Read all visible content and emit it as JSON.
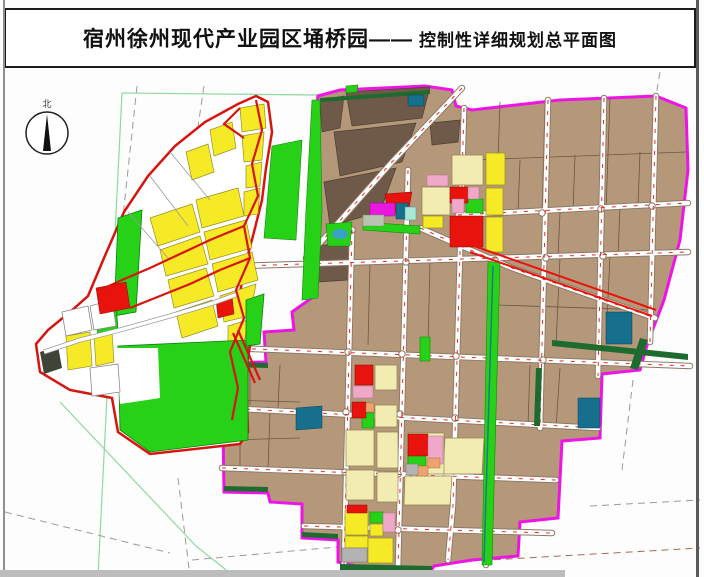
{
  "title": {
    "main": "宿州徐州现代产业园区埇桥园——",
    "sub": "控制性详细规划总平面图"
  },
  "compass": {
    "label": "北"
  },
  "palette": {
    "site_boundary_left": "#d6150f",
    "site_boundary_right": "#ee14e6",
    "industrial_tan": "#b5987a",
    "village_dark_brown": "#6f5948",
    "residential_yellow": "#f6e926",
    "residential_cream": "#f2ecb2",
    "green_space": "#27d117",
    "street_green": "#1d6b2f",
    "public_red": "#e8130c",
    "pink": "#f0a8c8",
    "orange": "#eda36f",
    "commercial_magenta": "#e818e0",
    "utility_teal": "#176f8e",
    "cyan": "#a8e8d8",
    "gray": "#b3b3b3"
  },
  "map": {
    "road_style": {
      "casing": "#8a7866",
      "casing_w": 6.5,
      "fill": "#ffffff",
      "fill_w": 4.6,
      "center": "#e03022"
    },
    "roads": [
      "240,266 688,252",
      "230,348 690,366",
      "224,408 598,428",
      "222,468 556,480",
      "304,526 552,533",
      "458,215 688,203",
      "352,230 344,565",
      "408,170 398,568",
      "464,108 453,505 448,560",
      "494,262 486,565",
      "548,100 540,428",
      "604,98 598,376",
      "656,96 650,342",
      "462,88 392,162 330,232 306,258",
      "420,228 512,268 655,318"
    ],
    "intersections": [
      [
        348,
        352
      ],
      [
        402,
        354
      ],
      [
        456,
        356
      ],
      [
        489,
        358
      ],
      [
        543,
        360
      ],
      [
        406,
        262
      ],
      [
        495,
        260
      ],
      [
        546,
        258
      ],
      [
        603,
        256
      ],
      [
        346,
        412
      ],
      [
        400,
        414
      ],
      [
        455,
        418
      ],
      [
        488,
        420
      ],
      [
        345,
        472
      ],
      [
        398,
        474
      ],
      [
        398,
        530
      ],
      [
        542,
        213
      ],
      [
        601,
        209
      ],
      [
        652,
        206
      ],
      [
        352,
        230
      ]
    ],
    "layers": [
      {
        "n": "survey-line-green",
        "t": "line",
        "s": "#8fd8a0",
        "w": 1.2,
        "sh": [
          "122,93 98,577",
          "122,93 318,95",
          "60,402 196,546",
          "196,546 235,577"
        ]
      },
      {
        "n": "survey-line-dashed",
        "t": "line",
        "s": "#9a9a9a",
        "w": 1,
        "d": "7 5",
        "sh": [
          "137,86 116,282",
          "204,86 178,262",
          "5,512 170,553",
          "178,478 190,577",
          "192,560 348,546",
          "633,380 622,470",
          "590,506 700,500",
          "660,72 656,96"
        ]
      },
      {
        "n": "survey-line-dashed-brown",
        "t": "line",
        "s": "#a06b50",
        "w": 1,
        "d": "7 5",
        "sh": [
          "350,568 700,548"
        ]
      },
      {
        "n": "site-east-boundary",
        "t": "poly",
        "f": "#b5987a",
        "s": "#ee14e6",
        "w": 3,
        "sh": [
          "318,96 340,90 425,86 452,90 456,106 472,110 560,100 656,96 686,108 688,170 680,240 664,300 648,342 640,370 602,374 600,438 562,441 558,518 520,522 518,556 472,560 434,566 430,572 390,572 356,566 338,562 338,540 302,538 302,504 270,502 268,493 224,492 222,363 266,362 264,332 294,330 292,312 313,297 310,200 314,130"
        ]
      },
      {
        "n": "parcel-village",
        "t": "poly",
        "f": "#6f5948",
        "s": "#4e3e30",
        "w": 0.7,
        "sh": [
          "346,92 430,87 422,118 352,126",
          "334,132 416,123 402,162 340,176",
          "324,182 396,168 380,212 330,226",
          "320,100 344,96 340,128 322,132",
          "430,123 460,120 458,142 432,145",
          "316,246 352,242 348,280 318,282"
        ]
      },
      {
        "n": "parcel-line",
        "t": "line",
        "s": "#6b5742",
        "w": 0.8,
        "sh": [
          "470,160 686,152",
          "545,102 542,215",
          "610,98 606,210",
          "655,96 652,205",
          "500,102 498,160",
          "520,160 518,212",
          "575,155 573,212",
          "640,152 638,205",
          "500,215 498,260",
          "560,212 558,258",
          "620,208 618,256",
          "560,258 556,345",
          "610,256 606,340",
          "498,305 650,310",
          "430,262 428,345",
          "370,262 368,345",
          "250,368 250,405",
          "280,365 278,408",
          "240,415 240,468",
          "270,412 268,470",
          "530,365 528,425",
          "560,368 556,428",
          "226,400 300,402",
          "226,440 300,438"
        ]
      },
      {
        "n": "road-network",
        "t": "roads"
      },
      {
        "n": "canal-greenway",
        "t": "poly",
        "f": "#27d117",
        "s": "#128a0a",
        "w": 0.6,
        "sh": [
          "488,262 500,262 492,565 482,565"
        ]
      },
      {
        "n": "canal-line",
        "t": "line",
        "s": "#1b7a8e",
        "w": 1.5,
        "sh": [
          "493,266 484,562"
        ]
      },
      {
        "n": "street-green-verge",
        "t": "poly",
        "f": "#1d6b2f",
        "sh": [
          "552,340 688,354 688,360 552,346",
          "340,564 432,566 432,572 340,570",
          "320,98 430,90 430,94 320,102",
          "536,368 542,368 540,426 534,426",
          "224,486 268,487 268,492 224,491",
          "302,532 338,534 338,539 302,537",
          "640,338 648,340 638,370 630,368",
          "224,362 268,363 268,368 224,367"
        ]
      },
      {
        "n": "parcel-cream",
        "t": "poly",
        "f": "#f2ecb2",
        "s": "#8f8350",
        "w": 0.7,
        "sh": [
          "452,155 483,155 483,185 452,185",
          "422,187 450,187 450,215 422,215",
          "346,430 374,430 374,466 346,466",
          "377,432 398,432 398,468 377,468",
          "445,438 484,438 482,474 443,474",
          "405,476 452,476 450,505 404,505",
          "346,470 374,470 374,500 346,500",
          "377,472 398,472 398,502 377,502",
          "375,365 397,365 397,390 375,390",
          "375,405 397,405 397,427 375,427",
          "408,433 444,433 444,474 408,474"
        ]
      },
      {
        "n": "parcel-green",
        "t": "poly",
        "f": "#27d117",
        "s": "#128a0a",
        "w": 0.6,
        "sh": [
          "312,100 320,100 322,210 318,298 302,300 306,210",
          "272,146 302,140 296,240 264,238",
          "326,224 352,222 350,246 328,246",
          "363,222 420,226 420,234 363,230",
          "466,199 483,199 483,213 466,213",
          "408,450 426,450 426,466 408,466",
          "362,413 374,413 374,428 362,428",
          "370,512 383,512 383,523 370,523",
          "420,337 430,337 430,361 420,361",
          "346,86 358,85 357,92 346,93"
        ]
      },
      {
        "n": "pond",
        "t": "ellipse",
        "f": "#3aa0c8",
        "sh": [
          [
            340,
            234,
            8,
            5
          ]
        ]
      },
      {
        "n": "parcel-yellow-east",
        "t": "poly",
        "f": "#f6e926",
        "s": "#97902a",
        "w": 0.7,
        "sh": [
          "486,153 505,153 505,185 486,185",
          "486,188 503,188 503,215 486,215",
          "486,217 503,217 503,252 486,252",
          "423,216 443,216 443,228 423,228",
          "345,510 368,510 368,535 345,535",
          "345,536 368,536 368,548 345,548",
          "368,538 393,538 393,563 368,563",
          "370,524 383,524 383,536 370,536"
        ]
      },
      {
        "n": "parcel-red",
        "t": "poly",
        "f": "#e8130c",
        "s": "#8f0a06",
        "w": 0.5,
        "sh": [
          "450,187 468,187 468,203 450,203",
          "450,216 483,216 483,247 450,247",
          "385,194 412,192 408,212 388,214",
          "355,365 373,365 373,385 355,385",
          "352,402 366,402 366,418 352,418",
          "408,434 428,434 428,456 408,456",
          "347,505 367,505 367,513 347,513"
        ]
      },
      {
        "n": "parcel-pink",
        "t": "poly",
        "f": "#f0a8c8",
        "s": "#b06f8d",
        "w": 0.5,
        "sh": [
          "427,175 448,175 448,186 427,186",
          "468,187 479,187 479,199 468,199",
          "353,386 373,386 373,398 353,398",
          "428,436 443,436 443,464 428,464",
          "383,513 395,513 395,532 383,532",
          "452,199 464,199 464,213 452,213"
        ]
      },
      {
        "n": "parcel-orange",
        "t": "poly",
        "f": "#eda36f",
        "s": "#a86a3a",
        "w": 0.5,
        "sh": [
          "427,458 440,458 440,468 427,468",
          "366,403 374,403 374,412 366,412",
          "416,466 428,466 428,476 416,476"
        ]
      },
      {
        "n": "parcel-commercial-magenta",
        "t": "poly",
        "f": "#e818e0",
        "s": "#8d0d88",
        "w": 0.5,
        "sh": [
          "370,203 395,203 395,216 370,216"
        ]
      },
      {
        "n": "parcel-teal",
        "t": "poly",
        "f": "#176f8e",
        "s": "#0d4456",
        "w": 0.5,
        "sh": [
          "396,203 408,203 408,219 396,219",
          "606,312 632,312 632,344 606,344",
          "408,95 424,95 424,106 408,106",
          "578,398 600,398 600,428 578,428",
          "296,408 322,406 322,428 296,430"
        ]
      },
      {
        "n": "parcel-cyan",
        "t": "poly",
        "f": "#a8e8d8",
        "s": "#4d9a8a",
        "w": 0.5,
        "sh": [
          "405,207 416,207 416,220 405,220"
        ]
      },
      {
        "n": "parcel-graygreen",
        "t": "poly",
        "f": "#b9c4b0",
        "s": "#7a8a72",
        "w": 0.5,
        "sh": [
          "363,215 384,215 384,226 363,226"
        ]
      },
      {
        "n": "parcel-gray",
        "t": "poly",
        "f": "#b3b3b3",
        "s": "#777777",
        "w": 0.5,
        "sh": [
          "342,548 367,548 367,562 342,562",
          "406,464 418,464 418,475 406,475"
        ]
      },
      {
        "n": "expressway-red",
        "t": "line",
        "s": "#e8130c",
        "w": 2,
        "sh": [
          "470,252 652,316",
          "474,246 656,310"
        ]
      },
      {
        "n": "site-west-boundary",
        "t": "poly",
        "f": "#ffffff",
        "s": "#d6150f",
        "w": 2.5,
        "sh": [
          "256,96 268,102 272,132 266,168 262,200 254,232 246,262 240,292 250,310 252,332 246,372 248,432 240,444 150,454 118,432 112,398 70,390 40,372 36,344 48,330 70,312 88,296 104,258 124,212 148,176 175,146 205,122 238,104"
        ]
      },
      {
        "n": "parcel-yellow-west",
        "t": "poly",
        "f": "#f6e926",
        "s": "#97902a",
        "w": 0.7,
        "sh": [
          "240,108 264,104 266,128 242,132",
          "242,136 264,132 262,160 244,162",
          "246,166 262,162 260,186 246,188",
          "244,192 260,188 258,214 244,216",
          "196,200 238,188 244,216 202,228",
          "150,218 192,204 200,232 158,246",
          "204,232 246,220 252,248 210,260",
          "160,250 200,236 208,264 166,276",
          "212,264 252,252 258,280 218,292",
          "168,280 206,268 214,296 174,308",
          "220,296 256,284 250,316 224,322",
          "176,312 212,300 218,326 182,338",
          "228,326 248,320 244,344 228,344",
          "210,130 232,122 236,148 214,156",
          "186,152 208,144 214,172 192,180",
          "66,336 90,332 92,366 68,370",
          "94,336 112,332 114,362 96,366"
        ]
      },
      {
        "n": "parcel-green-west",
        "t": "poly",
        "f": "#27d117",
        "s": "#0f7d12",
        "w": 0.8,
        "sh": [
          "118,218 142,210 136,312 114,316",
          "118,346 248,340 248,440 150,452 120,430",
          "96,310 116,304 118,330 98,336",
          "246,300 264,294 260,344 246,346"
        ]
      },
      {
        "n": "green-inlet-white",
        "t": "poly",
        "f": "#ffffff",
        "sh": [
          "116,348 158,348 160,398 120,404"
        ]
      },
      {
        "n": "parcel-white-west",
        "t": "poly",
        "f": "#ffffff",
        "s": "#8a8a8a",
        "w": 0.8,
        "sh": [
          "62,312 88,306 92,330 66,336",
          "90,306 112,300 116,326 94,330",
          "90,368 118,364 120,392 92,396"
        ]
      },
      {
        "n": "parcel-line-west",
        "t": "line",
        "s": "#9a9a9a",
        "w": 0.8,
        "sh": [
          "150,176 188,226",
          "170,152 210,200",
          "128,212 168,258"
        ]
      },
      {
        "n": "parcel-red-west",
        "t": "poly",
        "f": "#e8130c",
        "s": "#8f0a06",
        "w": 0.5,
        "sh": [
          "96,288 126,282 130,308 100,314",
          "216,300 232,296 234,314 218,318"
        ]
      },
      {
        "n": "parcel-dark-west",
        "t": "poly",
        "f": "#3f4438",
        "sh": [
          "40,352 58,346 62,368 44,374"
        ]
      },
      {
        "n": "west-road-casing",
        "t": "line",
        "s": "#9a9a9a",
        "w": 5,
        "sh": [
          "44,352 80,340 120,330 170,316 210,304 238,294"
        ]
      },
      {
        "n": "west-road",
        "t": "line",
        "s": "#ffffff",
        "w": 3.5,
        "sh": [
          "44,352 80,340 120,330 170,316 210,304 238,294"
        ]
      },
      {
        "n": "west-red-road",
        "t": "line",
        "s": "#d6150f",
        "w": 2.2,
        "sh": [
          "256,100 262,130 252,164 258,196 244,226 250,258 236,290 244,318 230,352 238,388 232,420",
          "244,226 210,240 180,254 150,268 122,280 100,290",
          "250,258 220,270 190,284 160,296 130,308",
          "240,108 224,124 244,138",
          "238,330 260,380",
          "233,333 255,383"
        ]
      },
      {
        "n": "compass-circle",
        "t": "circle",
        "f": "#ffffff",
        "s": "#222222",
        "w": 1.5,
        "sh": [
          [
            47,
            133,
            21
          ]
        ]
      },
      {
        "n": "compass-needle",
        "t": "poly",
        "f": "#111111",
        "sh": [
          "47,114 43,151 51,151"
        ]
      },
      {
        "n": "compass-label",
        "t": "text",
        "x": 47,
        "y": 107,
        "size": 9,
        "f": "#333333",
        "bind": "compass.label"
      }
    ]
  }
}
